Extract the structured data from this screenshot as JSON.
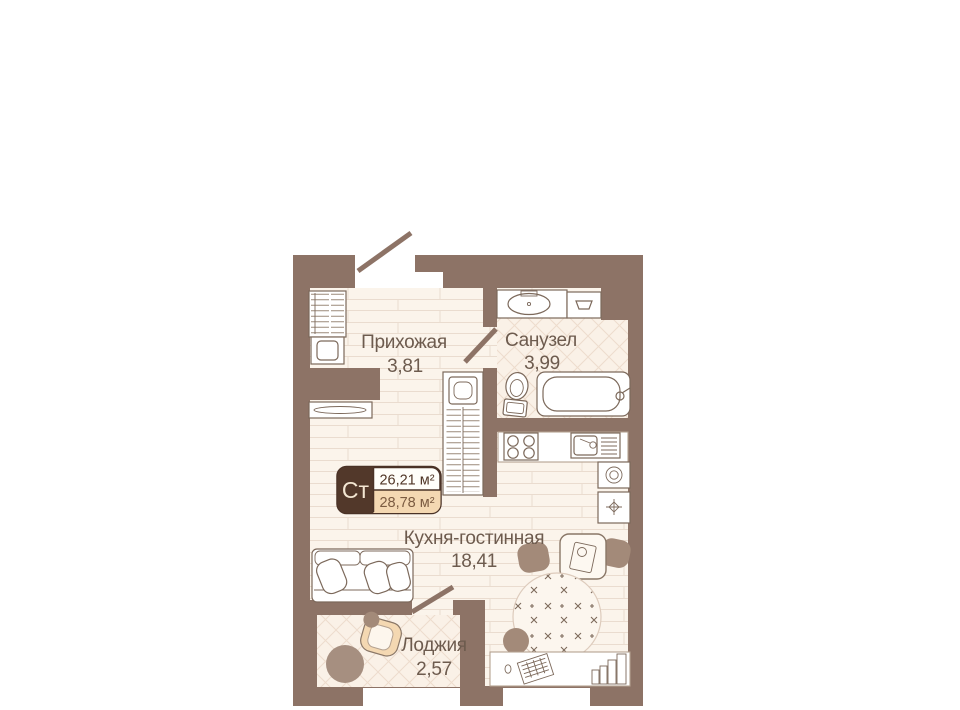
{
  "plan": {
    "badge": {
      "code": "Ст",
      "area_total": "26,21 м²",
      "area_with_balcony": "28,78 м²"
    },
    "rooms": [
      {
        "name": "Прихожая",
        "area": "3,81"
      },
      {
        "name": "Санузел",
        "area": "3,99"
      },
      {
        "name": "Кухня-гостинная",
        "area": "18,41"
      },
      {
        "name": "Лоджия",
        "area": "2,57"
      }
    ],
    "colors": {
      "wall": "#8d7366",
      "floor": "#fbf4eb",
      "tile": "#faf1e7",
      "furn": "#a38a79",
      "tan": "#f4d8b2",
      "line": "#7c695b",
      "text": "#6d5b4e",
      "badge": "#52382a"
    }
  }
}
